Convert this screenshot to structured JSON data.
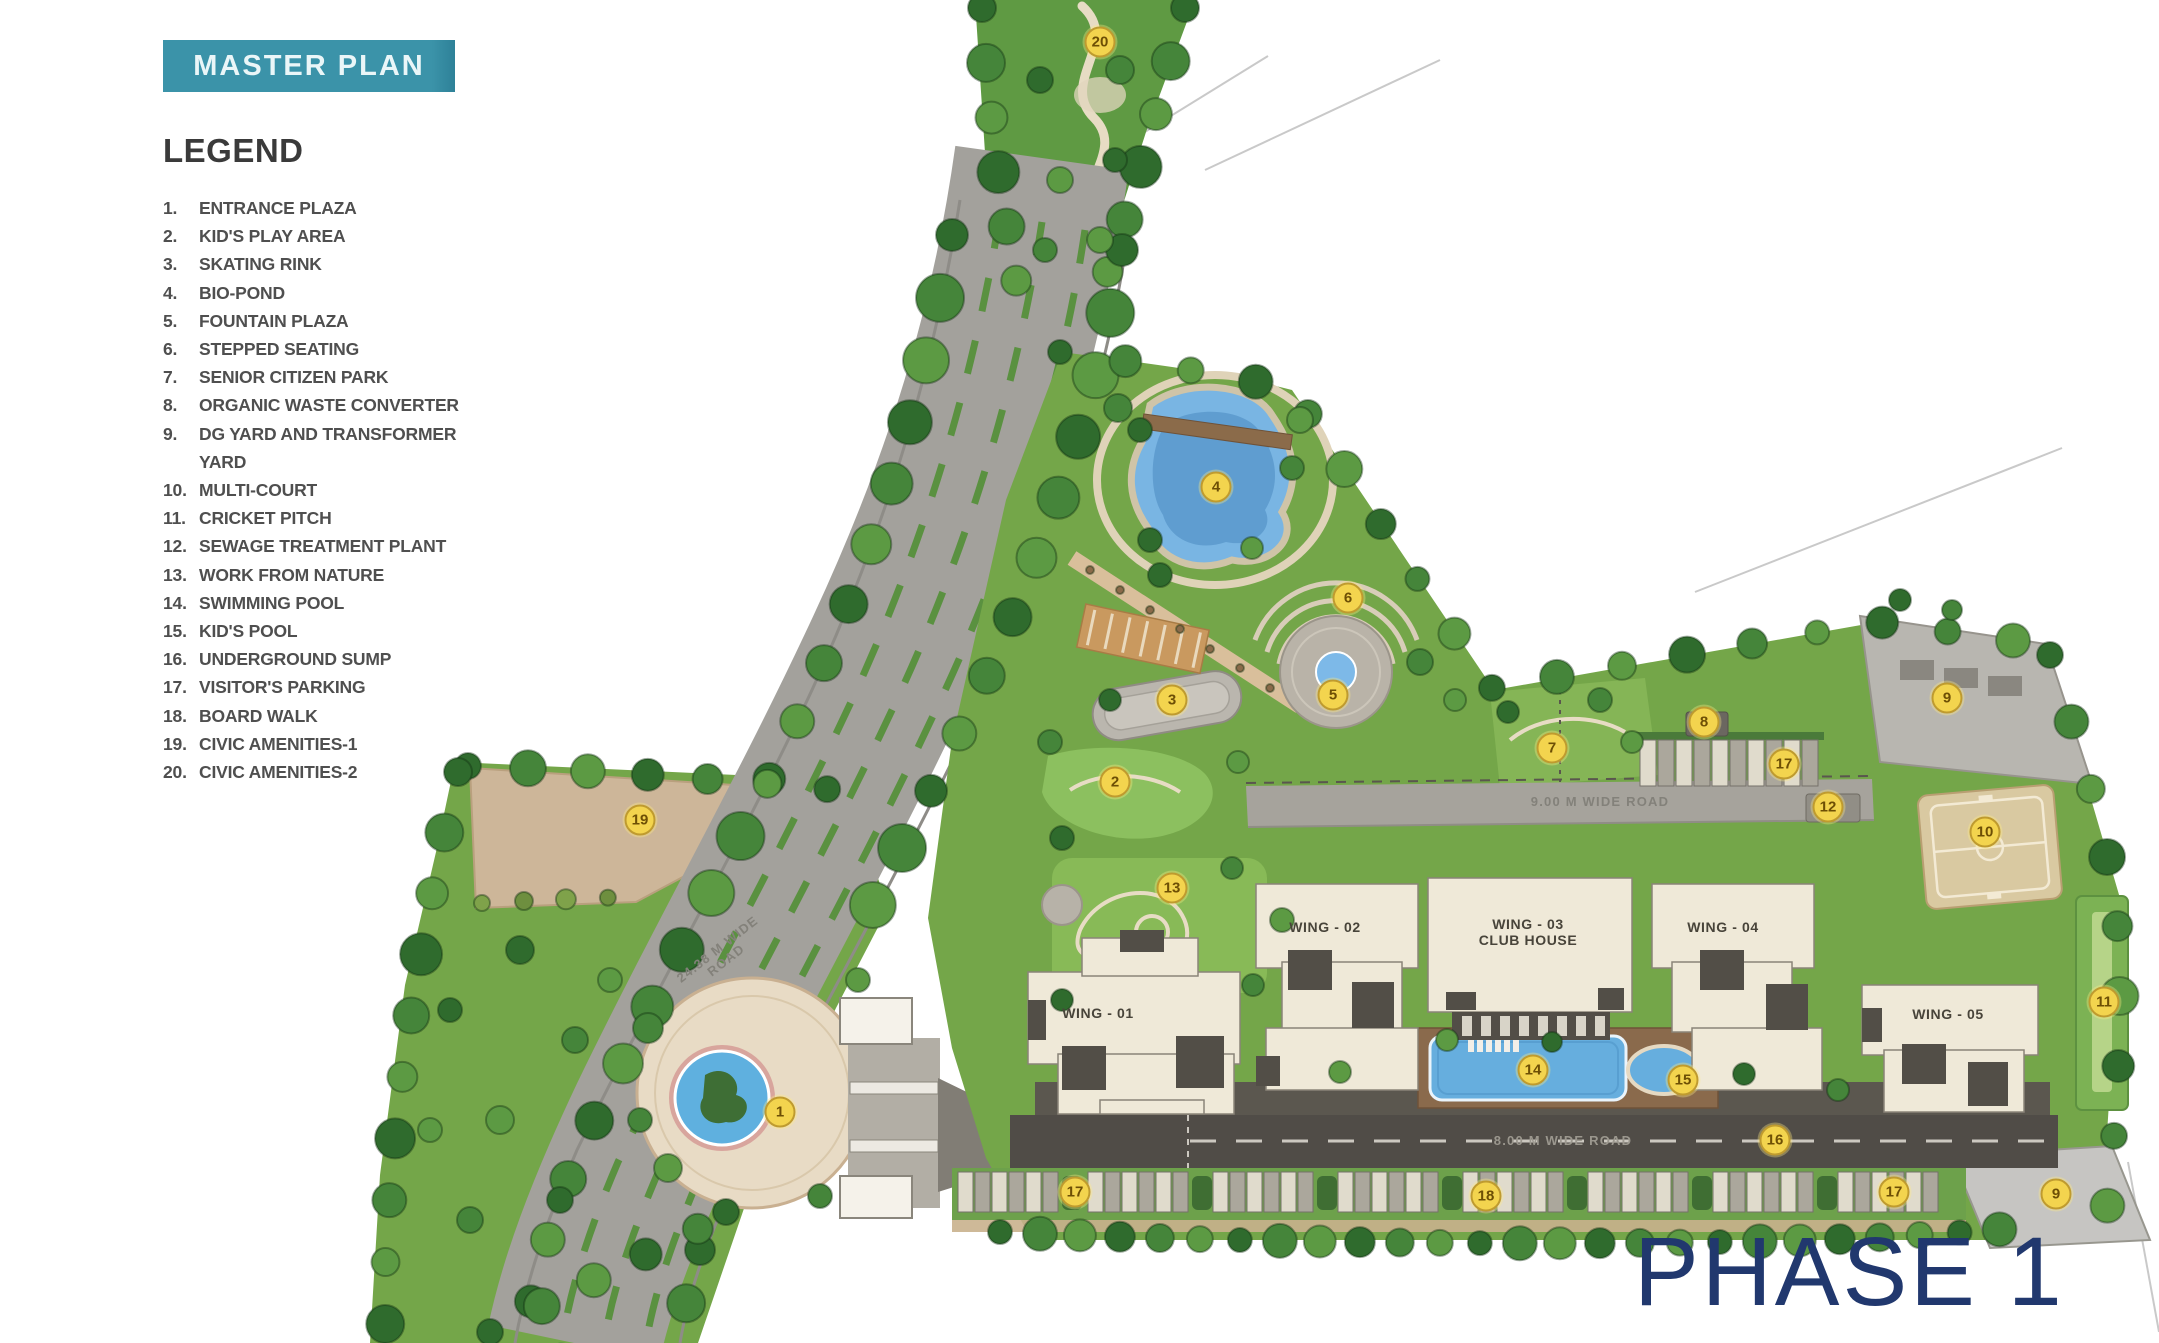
{
  "page": {
    "title_badge": "MASTER PLAN",
    "phase_label": "PHASE 1"
  },
  "colors": {
    "badge_teal": "#3b93a9",
    "phase_navy": "#21386e",
    "marker_yellow": "#f3d44e",
    "legend_text": "#4f4f4f",
    "grass_green": "#74a649",
    "road_gray": "#a3a19c",
    "building_cream": "#efe9d8",
    "pool_blue": "#66aede"
  },
  "legend": {
    "title": "LEGEND",
    "items": [
      {
        "num": "1.",
        "label": "ENTRANCE PLAZA"
      },
      {
        "num": "2.",
        "label": "KID'S PLAY AREA"
      },
      {
        "num": "3.",
        "label": "SKATING RINK"
      },
      {
        "num": "4.",
        "label": "BIO-POND"
      },
      {
        "num": "5.",
        "label": "FOUNTAIN PLAZA"
      },
      {
        "num": "6.",
        "label": "STEPPED SEATING"
      },
      {
        "num": "7.",
        "label": "SENIOR CITIZEN PARK"
      },
      {
        "num": "8.",
        "label": "ORGANIC WASTE CONVERTER"
      },
      {
        "num": "9.",
        "label": "DG YARD AND TRANSFORMER YARD"
      },
      {
        "num": "10.",
        "label": "MULTI-COURT"
      },
      {
        "num": "11.",
        "label": "CRICKET PITCH"
      },
      {
        "num": "12.",
        "label": "SEWAGE TREATMENT PLANT"
      },
      {
        "num": "13.",
        "label": "WORK FROM NATURE"
      },
      {
        "num": "14.",
        "label": "SWIMMING POOL"
      },
      {
        "num": "15.",
        "label": "KID'S POOL"
      },
      {
        "num": "16.",
        "label": "UNDERGROUND SUMP"
      },
      {
        "num": "17.",
        "label": "VISITOR'S PARKING"
      },
      {
        "num": "18.",
        "label": "BOARD WALK"
      },
      {
        "num": "19.",
        "label": "CIVIC AMENITIES-1"
      },
      {
        "num": "20.",
        "label": "CIVIC AMENITIES-2"
      }
    ]
  },
  "map": {
    "wings": [
      {
        "line1": "WING - 01",
        "line2": "",
        "x": 1098,
        "y": 1013
      },
      {
        "line1": "WING - 02",
        "line2": "",
        "x": 1325,
        "y": 927
      },
      {
        "line1": "WING - 03",
        "line2": "CLUB HOUSE",
        "x": 1528,
        "y": 932
      },
      {
        "line1": "WING - 04",
        "line2": "",
        "x": 1723,
        "y": 927
      },
      {
        "line1": "WING - 05",
        "line2": "",
        "x": 1948,
        "y": 1014
      }
    ],
    "road_labels": [
      {
        "line1": "24.38 M WIDE",
        "line2": "ROAD",
        "x": 722,
        "y": 955,
        "rotate": -38,
        "cls": ""
      },
      {
        "line1": "9.00 M WIDE ROAD",
        "line2": "",
        "x": 1600,
        "y": 802,
        "rotate": 0,
        "cls": ""
      },
      {
        "line1": "8.00 M WIDE ROAD",
        "line2": "",
        "x": 1563,
        "y": 1141,
        "rotate": 0,
        "cls": "dark"
      }
    ],
    "markers": [
      {
        "num": "1",
        "label": "entrance-plaza",
        "x": 780,
        "y": 1112
      },
      {
        "num": "2",
        "label": "kids-play-area",
        "x": 1115,
        "y": 782
      },
      {
        "num": "3",
        "label": "skating-rink",
        "x": 1172,
        "y": 700
      },
      {
        "num": "4",
        "label": "bio-pond",
        "x": 1216,
        "y": 487
      },
      {
        "num": "5",
        "label": "fountain-plaza",
        "x": 1333,
        "y": 695
      },
      {
        "num": "6",
        "label": "stepped-seating",
        "x": 1348,
        "y": 598
      },
      {
        "num": "7",
        "label": "senior-citizen-park",
        "x": 1552,
        "y": 748
      },
      {
        "num": "8",
        "label": "organic-waste-converter",
        "x": 1704,
        "y": 722
      },
      {
        "num": "9",
        "label": "dg-yard-transformer-yard",
        "x": 1947,
        "y": 698
      },
      {
        "num": "10",
        "label": "multi-court",
        "x": 1985,
        "y": 832
      },
      {
        "num": "11",
        "label": "cricket-pitch",
        "x": 2104,
        "y": 1002
      },
      {
        "num": "12",
        "label": "sewage-treatment-plant",
        "x": 1828,
        "y": 807
      },
      {
        "num": "13",
        "label": "work-from-nature",
        "x": 1172,
        "y": 888
      },
      {
        "num": "14",
        "label": "swimming-pool",
        "x": 1533,
        "y": 1070
      },
      {
        "num": "15",
        "label": "kids-pool",
        "x": 1683,
        "y": 1080
      },
      {
        "num": "16",
        "label": "underground-sump",
        "x": 1775,
        "y": 1140
      },
      {
        "num": "17",
        "label": "visitors-parking",
        "x": 1784,
        "y": 764
      },
      {
        "num": "17",
        "label": "visitors-parking",
        "x": 1075,
        "y": 1192
      },
      {
        "num": "17",
        "label": "visitors-parking",
        "x": 1894,
        "y": 1192
      },
      {
        "num": "18",
        "label": "board-walk",
        "x": 1486,
        "y": 1196
      },
      {
        "num": "19",
        "label": "civic-amenities-1",
        "x": 640,
        "y": 820
      },
      {
        "num": "20",
        "label": "civic-amenities-2",
        "x": 1100,
        "y": 42
      },
      {
        "num": "9",
        "label": "dg-yard-transformer-yard",
        "x": 2056,
        "y": 1194
      }
    ]
  }
}
